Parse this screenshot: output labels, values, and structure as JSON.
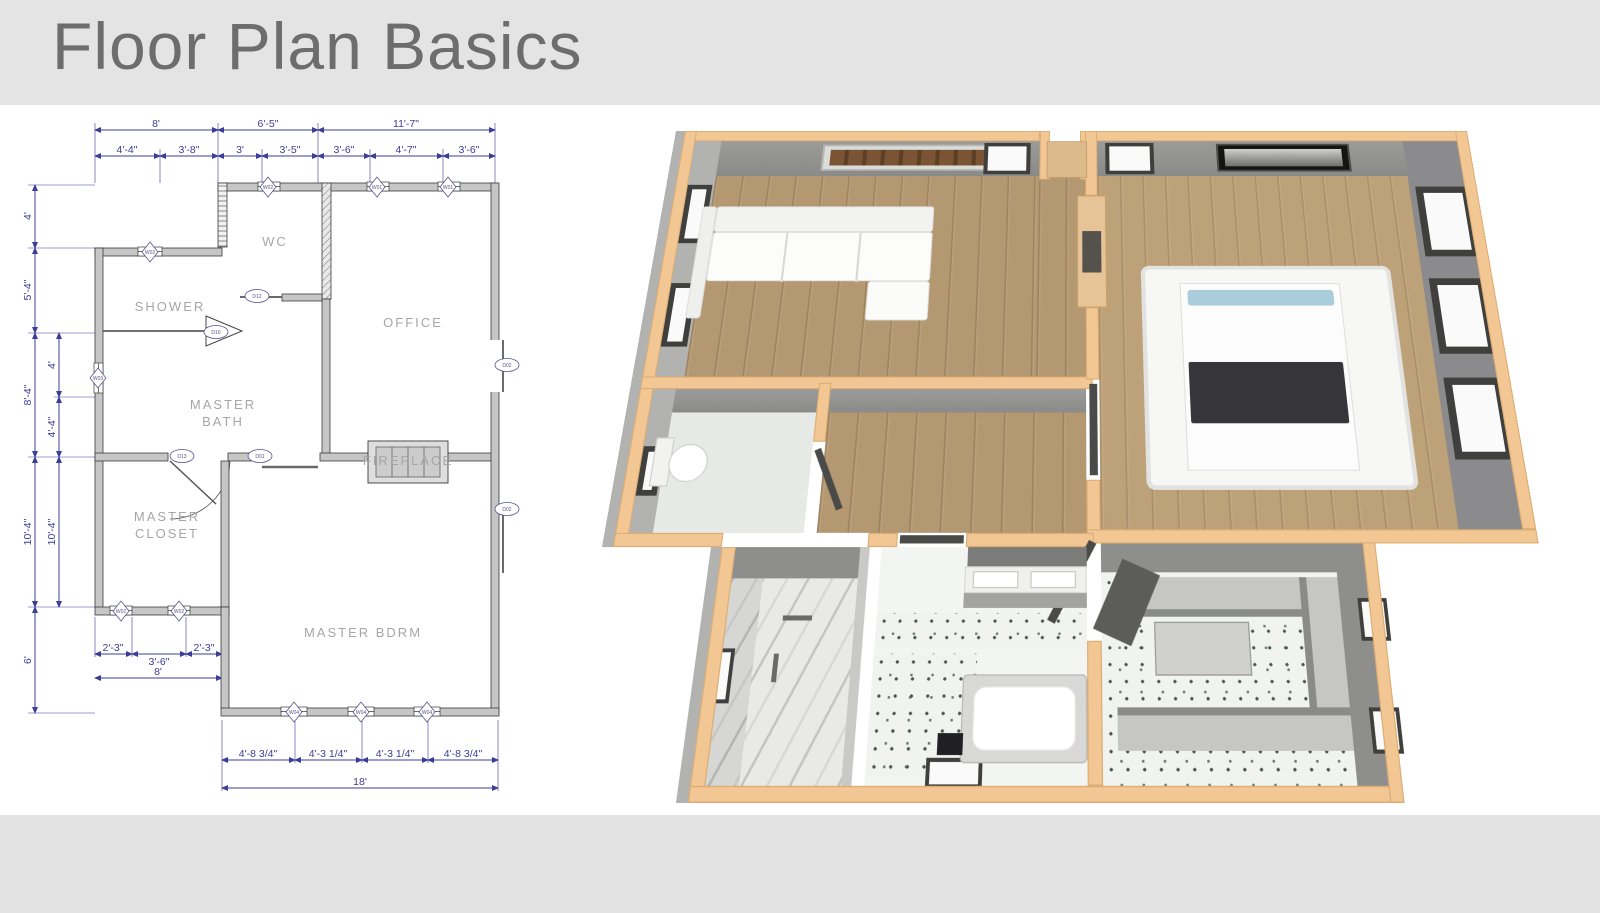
{
  "title": "Floor Plan Basics",
  "plan2d": {
    "room_labels": {
      "shower": "SHOWER",
      "wc": "WC",
      "office": "OFFICE",
      "master_bath_line1": "MASTER",
      "master_bath_line2": "BATH",
      "master_closet_line1": "MASTER",
      "master_closet_line2": "CLOSET",
      "master_bdrm": "MASTER BDRM",
      "fireplace": "FIREPLACE"
    },
    "dims": {
      "top_row1": [
        "8'",
        "6'-5\"",
        "11'-7\""
      ],
      "top_row2": [
        "4'-4\"",
        "3'-8\"",
        "3'",
        "3'-5\"",
        "3'-6\"",
        "4'-7\"",
        "3'-6\""
      ],
      "left_col1": [
        "4'",
        "5'-4\"",
        "8'-4\"",
        "10'-4\"",
        "6'"
      ],
      "left_col2": [
        "4'",
        "4'-4\"",
        "10'-4\""
      ],
      "closet_row": [
        "2'-3\"",
        "3'-6\"",
        "2'-3\""
      ],
      "closet_total": "8'",
      "bdrm_row": [
        "4'-8 3/4\"",
        "4'-3 1/4\"",
        "4'-3 1/4\"",
        "4'-8 3/4\""
      ],
      "bdrm_total": "18'"
    },
    "window_markers": {
      "top": [
        "W02",
        "W01",
        "W01"
      ],
      "shower": "W02",
      "left": "W03",
      "closet": [
        "W02",
        "W02"
      ],
      "bdrm": [
        "W04",
        "W04",
        "W04"
      ]
    },
    "door_markers": {
      "shower": "D10",
      "wc": "D12",
      "closet": "D13",
      "bdrm_hall": "D01",
      "office_right": "D02",
      "bdrm_right": "D02"
    }
  },
  "colors": {
    "banner": "#e4e4e4",
    "title_text": "#6d6d6d",
    "dimension_blue": "#3c3c99",
    "wall_gray": "#c6c6c6",
    "wall_cap_tan": "#f3c793",
    "render_wall_gray": "#9b9b99",
    "wood_floor": "#b49872"
  }
}
